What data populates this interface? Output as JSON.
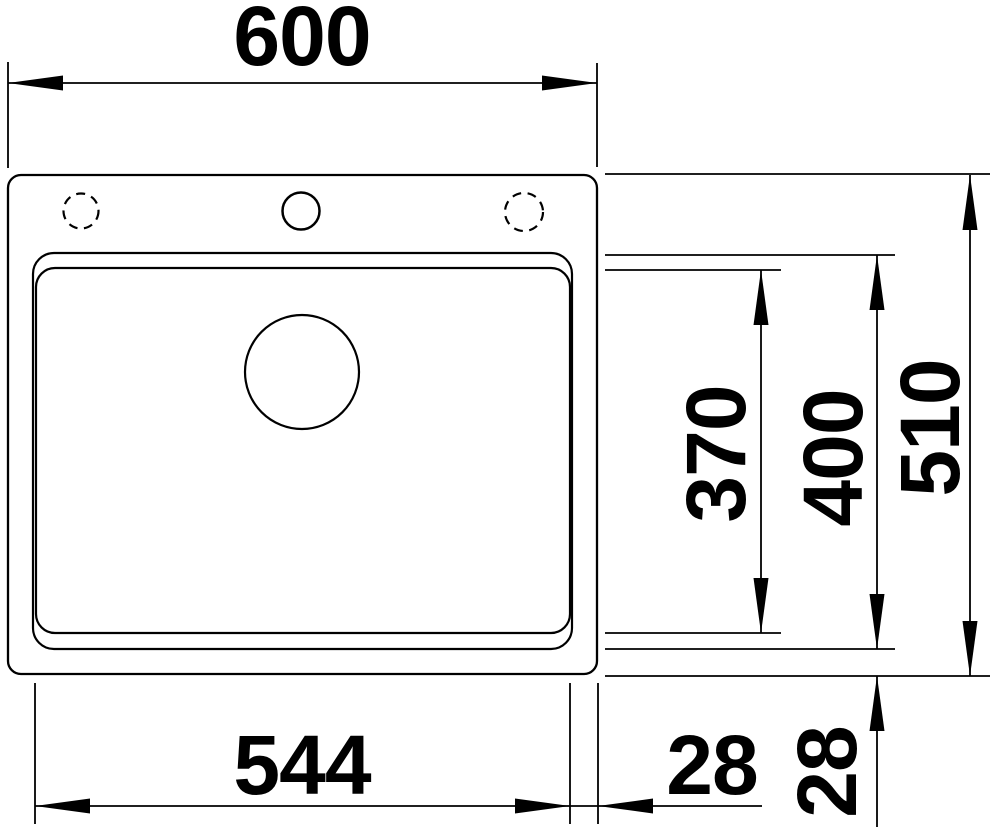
{
  "drawing": {
    "type": "technical-dimension-drawing",
    "subject": "inset sink with single bowl, top view",
    "background_color": "#ffffff",
    "line_color": "#000000",
    "dimensions": {
      "overall_width": "600",
      "overall_depth": "510",
      "bowl_width": "544",
      "bowl_outer_depth": "400",
      "bowl_inner_depth": "370",
      "bowl_to_edge_right": "28",
      "bowl_to_edge_bottom": "28"
    }
  }
}
